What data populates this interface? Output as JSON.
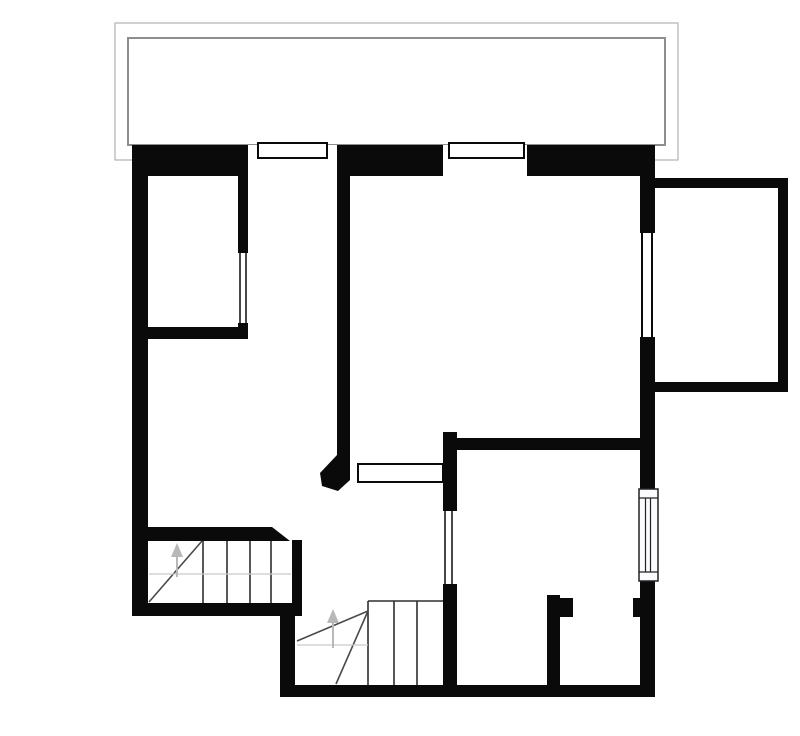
{
  "canvas": {
    "width": 800,
    "height": 736,
    "background": "#ffffff"
  },
  "palette": {
    "wall": "#0a0a0a",
    "white": "#ffffff",
    "tread": "#2e2e2e",
    "diag": "#4a4a4a",
    "guide": "#cacaca",
    "arrow": "#b8b8b8",
    "radline": "#222222",
    "radfill": "#fbfbfd",
    "terrace-outer": "#b2b2b2",
    "terrace-inner": "#8e8e8e",
    "none": "none"
  },
  "plan": {
    "description": "floor-plan",
    "shapes": [
      {
        "t": "rect",
        "n": "terrace-outer-outline",
        "x": 115,
        "y": 23,
        "w": 563,
        "h": 137,
        "f": "none",
        "s": "terrace-outer",
        "sw": 1.2
      },
      {
        "t": "rect",
        "n": "terrace-inner-outline",
        "x": 128,
        "y": 38,
        "w": 537,
        "h": 107,
        "f": "none",
        "s": "terrace-inner",
        "sw": 2
      },
      {
        "t": "rect",
        "n": "wall-top",
        "x": 132,
        "y": 145,
        "w": 523,
        "h": 31,
        "f": "wall"
      },
      {
        "t": "rect",
        "n": "wall-left",
        "x": 132,
        "y": 145,
        "w": 16,
        "h": 471,
        "f": "wall"
      },
      {
        "t": "rect",
        "n": "wall-right-upper",
        "x": 640,
        "y": 176,
        "w": 15,
        "h": 57,
        "f": "wall"
      },
      {
        "t": "rect",
        "n": "wall-right-middle",
        "x": 640,
        "y": 337,
        "w": 15,
        "h": 153,
        "f": "wall"
      },
      {
        "t": "rect",
        "n": "wall-right-lower",
        "x": 640,
        "y": 579,
        "w": 15,
        "h": 118,
        "f": "wall"
      },
      {
        "t": "rect",
        "n": "wall-room1-bottom",
        "x": 132,
        "y": 327,
        "w": 116,
        "h": 12,
        "f": "wall"
      },
      {
        "t": "rect",
        "n": "wall-room1-right",
        "x": 238,
        "y": 176,
        "w": 10,
        "h": 77,
        "f": "wall"
      },
      {
        "t": "rect",
        "n": "wall-room1-right-corner",
        "x": 238,
        "y": 323,
        "w": 10,
        "h": 16,
        "f": "wall"
      },
      {
        "t": "rect",
        "n": "wall-central",
        "x": 337,
        "y": 176,
        "w": 13,
        "h": 286,
        "f": "wall"
      },
      {
        "t": "rect",
        "n": "wall-pass-jamb",
        "x": 443,
        "y": 432,
        "w": 14,
        "h": 79,
        "f": "wall"
      },
      {
        "t": "rect",
        "n": "wall-room2-left-lower",
        "x": 443,
        "y": 584,
        "w": 14,
        "h": 113,
        "f": "wall"
      },
      {
        "t": "rect",
        "n": "wall-room2-top",
        "x": 450,
        "y": 438,
        "w": 190,
        "h": 12,
        "f": "wall"
      },
      {
        "t": "rect",
        "n": "wall-stairs-bottom",
        "x": 132,
        "y": 603,
        "w": 170,
        "h": 13,
        "f": "wall"
      },
      {
        "t": "rect",
        "n": "wall-stair-edge",
        "x": 292,
        "y": 540,
        "w": 10,
        "h": 63,
        "f": "wall"
      },
      {
        "t": "rect",
        "n": "wall-stairbay-left",
        "x": 280,
        "y": 603,
        "w": 15,
        "h": 94,
        "f": "wall"
      },
      {
        "t": "rect",
        "n": "wall-bottom",
        "x": 280,
        "y": 685,
        "w": 375,
        "h": 12,
        "f": "wall"
      },
      {
        "t": "rect",
        "n": "wall-wc-left",
        "x": 547,
        "y": 595,
        "w": 13,
        "h": 90,
        "f": "wall"
      },
      {
        "t": "rect",
        "n": "wall-wc-stub-left",
        "x": 560,
        "y": 598,
        "w": 13,
        "h": 19,
        "f": "wall"
      },
      {
        "t": "rect",
        "n": "wall-wc-stub-right",
        "x": 633,
        "y": 598,
        "w": 7,
        "h": 19,
        "f": "wall"
      },
      {
        "t": "rect",
        "n": "wall-balcony-top",
        "x": 655,
        "y": 178,
        "w": 133,
        "h": 10,
        "f": "wall"
      },
      {
        "t": "rect",
        "n": "wall-balcony-right",
        "x": 778,
        "y": 178,
        "w": 10,
        "h": 214,
        "f": "wall"
      },
      {
        "t": "rect",
        "n": "wall-balcony-bottom",
        "x": 655,
        "y": 382,
        "w": 133,
        "h": 10,
        "f": "wall"
      },
      {
        "t": "poly",
        "n": "wall-stair-top-chamfer",
        "p": "132,527 272,527 290,541 132,541",
        "f": "wall"
      },
      {
        "t": "poly",
        "n": "wall-central-end-chamfer",
        "p": "337,455 350,455 350,480 338,491 322,486 320,473",
        "f": "wall"
      },
      {
        "t": "rect",
        "n": "window-top1-gap",
        "x": 248,
        "y": 145,
        "w": 89,
        "h": 31,
        "f": "white"
      },
      {
        "t": "rect",
        "n": "window-top1-frame",
        "x": 258,
        "y": 143,
        "w": 69,
        "h": 15,
        "f": "white",
        "s": "wall",
        "sw": 2
      },
      {
        "t": "rect",
        "n": "window-top2-gap",
        "x": 443,
        "y": 145,
        "w": 84,
        "h": 31,
        "f": "white"
      },
      {
        "t": "rect",
        "n": "window-top2-frame",
        "x": 449,
        "y": 143,
        "w": 75,
        "h": 15,
        "f": "white",
        "s": "wall",
        "sw": 2
      },
      {
        "t": "rect",
        "n": "window-balcony-gap",
        "x": 640,
        "y": 233,
        "w": 15,
        "h": 104,
        "f": "white"
      },
      {
        "t": "line",
        "n": "window-balcony-line-a",
        "x1": 642,
        "y1": 233,
        "x2": 642,
        "y2": 337,
        "s": "wall",
        "sw": 2
      },
      {
        "t": "line",
        "n": "window-balcony-line-b",
        "x1": 652,
        "y1": 233,
        "x2": 652,
        "y2": 337,
        "s": "wall",
        "sw": 2
      },
      {
        "t": "line",
        "n": "window-room1-line-a",
        "x1": 240,
        "y1": 253,
        "x2": 240,
        "y2": 323,
        "s": "wall",
        "sw": 1.5
      },
      {
        "t": "line",
        "n": "window-room1-line-b",
        "x1": 246,
        "y1": 253,
        "x2": 246,
        "y2": 323,
        "s": "wall",
        "sw": 1.5
      },
      {
        "t": "line",
        "n": "window-room2-line-a",
        "x1": 445,
        "y1": 511,
        "x2": 445,
        "y2": 584,
        "s": "wall",
        "sw": 1.5
      },
      {
        "t": "line",
        "n": "window-room2-line-b",
        "x1": 452,
        "y1": 511,
        "x2": 452,
        "y2": 584,
        "s": "wall",
        "sw": 1.5
      },
      {
        "t": "rect",
        "n": "window-pass-frame",
        "x": 358,
        "y": 464,
        "w": 85,
        "h": 18,
        "f": "white",
        "s": "wall",
        "sw": 2
      },
      {
        "t": "rect",
        "n": "radiator-body",
        "x": 639,
        "y": 489,
        "w": 19,
        "h": 92,
        "f": "radfill",
        "s": "radline",
        "sw": 1.5
      },
      {
        "t": "line",
        "n": "radiator-cap-top",
        "x1": 639,
        "y1": 498,
        "x2": 658,
        "y2": 498,
        "s": "radline",
        "sw": 1.2
      },
      {
        "t": "line",
        "n": "radiator-cap-bottom",
        "x1": 639,
        "y1": 572,
        "x2": 658,
        "y2": 572,
        "s": "radline",
        "sw": 1.2
      },
      {
        "t": "line",
        "n": "radiator-fin-a",
        "x1": 645.5,
        "y1": 498,
        "x2": 645.5,
        "y2": 572,
        "s": "radline",
        "sw": 1.2
      },
      {
        "t": "line",
        "n": "radiator-fin-b",
        "x1": 650.5,
        "y1": 498,
        "x2": 650.5,
        "y2": 572,
        "s": "radline",
        "sw": 1.2
      },
      {
        "t": "line",
        "n": "stair1-tread-1",
        "x1": 203,
        "y1": 541,
        "x2": 203,
        "y2": 603,
        "s": "tread",
        "sw": 1.6
      },
      {
        "t": "line",
        "n": "stair1-tread-2",
        "x1": 227,
        "y1": 541,
        "x2": 227,
        "y2": 603,
        "s": "tread",
        "sw": 1.6
      },
      {
        "t": "line",
        "n": "stair1-tread-3",
        "x1": 250,
        "y1": 541,
        "x2": 250,
        "y2": 603,
        "s": "tread",
        "sw": 1.6
      },
      {
        "t": "line",
        "n": "stair1-tread-4",
        "x1": 271,
        "y1": 541,
        "x2": 271,
        "y2": 603,
        "s": "tread",
        "sw": 1.6
      },
      {
        "t": "line",
        "n": "stair1-diagonal",
        "x1": 149,
        "y1": 602,
        "x2": 202,
        "y2": 541,
        "s": "diag",
        "sw": 1.6
      },
      {
        "t": "line",
        "n": "stair1-guide",
        "x1": 149,
        "y1": 574,
        "x2": 291,
        "y2": 574,
        "s": "guide",
        "sw": 1.2
      },
      {
        "t": "line",
        "n": "stair2-top-edge",
        "x1": 368,
        "y1": 601,
        "x2": 443,
        "y2": 601,
        "s": "tread",
        "sw": 1.6
      },
      {
        "t": "line",
        "n": "stair2-tread-1",
        "x1": 368,
        "y1": 601,
        "x2": 368,
        "y2": 685,
        "s": "tread",
        "sw": 1.6
      },
      {
        "t": "line",
        "n": "stair2-tread-2",
        "x1": 394,
        "y1": 601,
        "x2": 394,
        "y2": 685,
        "s": "tread",
        "sw": 1.6
      },
      {
        "t": "line",
        "n": "stair2-tread-3",
        "x1": 417,
        "y1": 601,
        "x2": 417,
        "y2": 685,
        "s": "tread",
        "sw": 1.6
      },
      {
        "t": "line",
        "n": "stair2-winder-1",
        "x1": 368,
        "y1": 611,
        "x2": 297,
        "y2": 641,
        "s": "diag",
        "sw": 1.6
      },
      {
        "t": "line",
        "n": "stair2-winder-2",
        "x1": 368,
        "y1": 611,
        "x2": 336,
        "y2": 684,
        "s": "diag",
        "sw": 1.6
      },
      {
        "t": "line",
        "n": "stair2-guide",
        "x1": 297,
        "y1": 645,
        "x2": 368,
        "y2": 645,
        "s": "guide",
        "sw": 1.2
      },
      {
        "t": "line",
        "n": "stair1-up-arrow-stem",
        "x1": 177,
        "y1": 577,
        "x2": 177,
        "y2": 556,
        "s": "arrow",
        "sw": 2
      },
      {
        "t": "poly",
        "n": "stair1-up-arrow-head",
        "p": "177,543 171,557 183,557",
        "f": "arrow"
      },
      {
        "t": "line",
        "n": "stair2-up-arrow-stem",
        "x1": 333,
        "y1": 648,
        "x2": 333,
        "y2": 622,
        "s": "arrow",
        "sw": 2
      },
      {
        "t": "poly",
        "n": "stair2-up-arrow-head",
        "p": "333,609 327,623 339,623",
        "f": "arrow"
      }
    ]
  }
}
